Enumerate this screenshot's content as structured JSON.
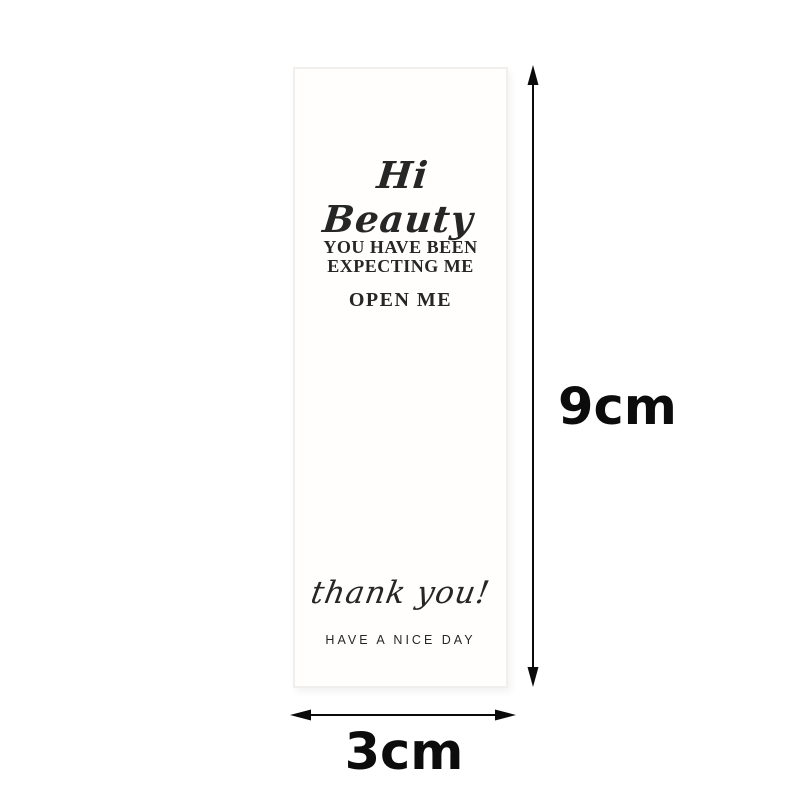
{
  "card": {
    "greeting": "Hi Beauty",
    "message_line1": "YOU HAVE BEEN",
    "message_line2": "EXPECTING ME",
    "open_label": "OPEN ME",
    "thanks": "thank you!",
    "footer": "HAVE A NICE DAY"
  },
  "dimensions": {
    "height": "9cm",
    "width": "3cm"
  },
  "icons": {
    "vertical_arrow": "double-headed-vertical-arrow",
    "horizontal_arrow": "double-headed-horizontal-arrow"
  },
  "colors": {
    "background": "#ffffff",
    "card_background": "#fffefd",
    "card_border": "#f0efed",
    "text": "#2b2b2b",
    "arrow": "#0a0a0a"
  }
}
